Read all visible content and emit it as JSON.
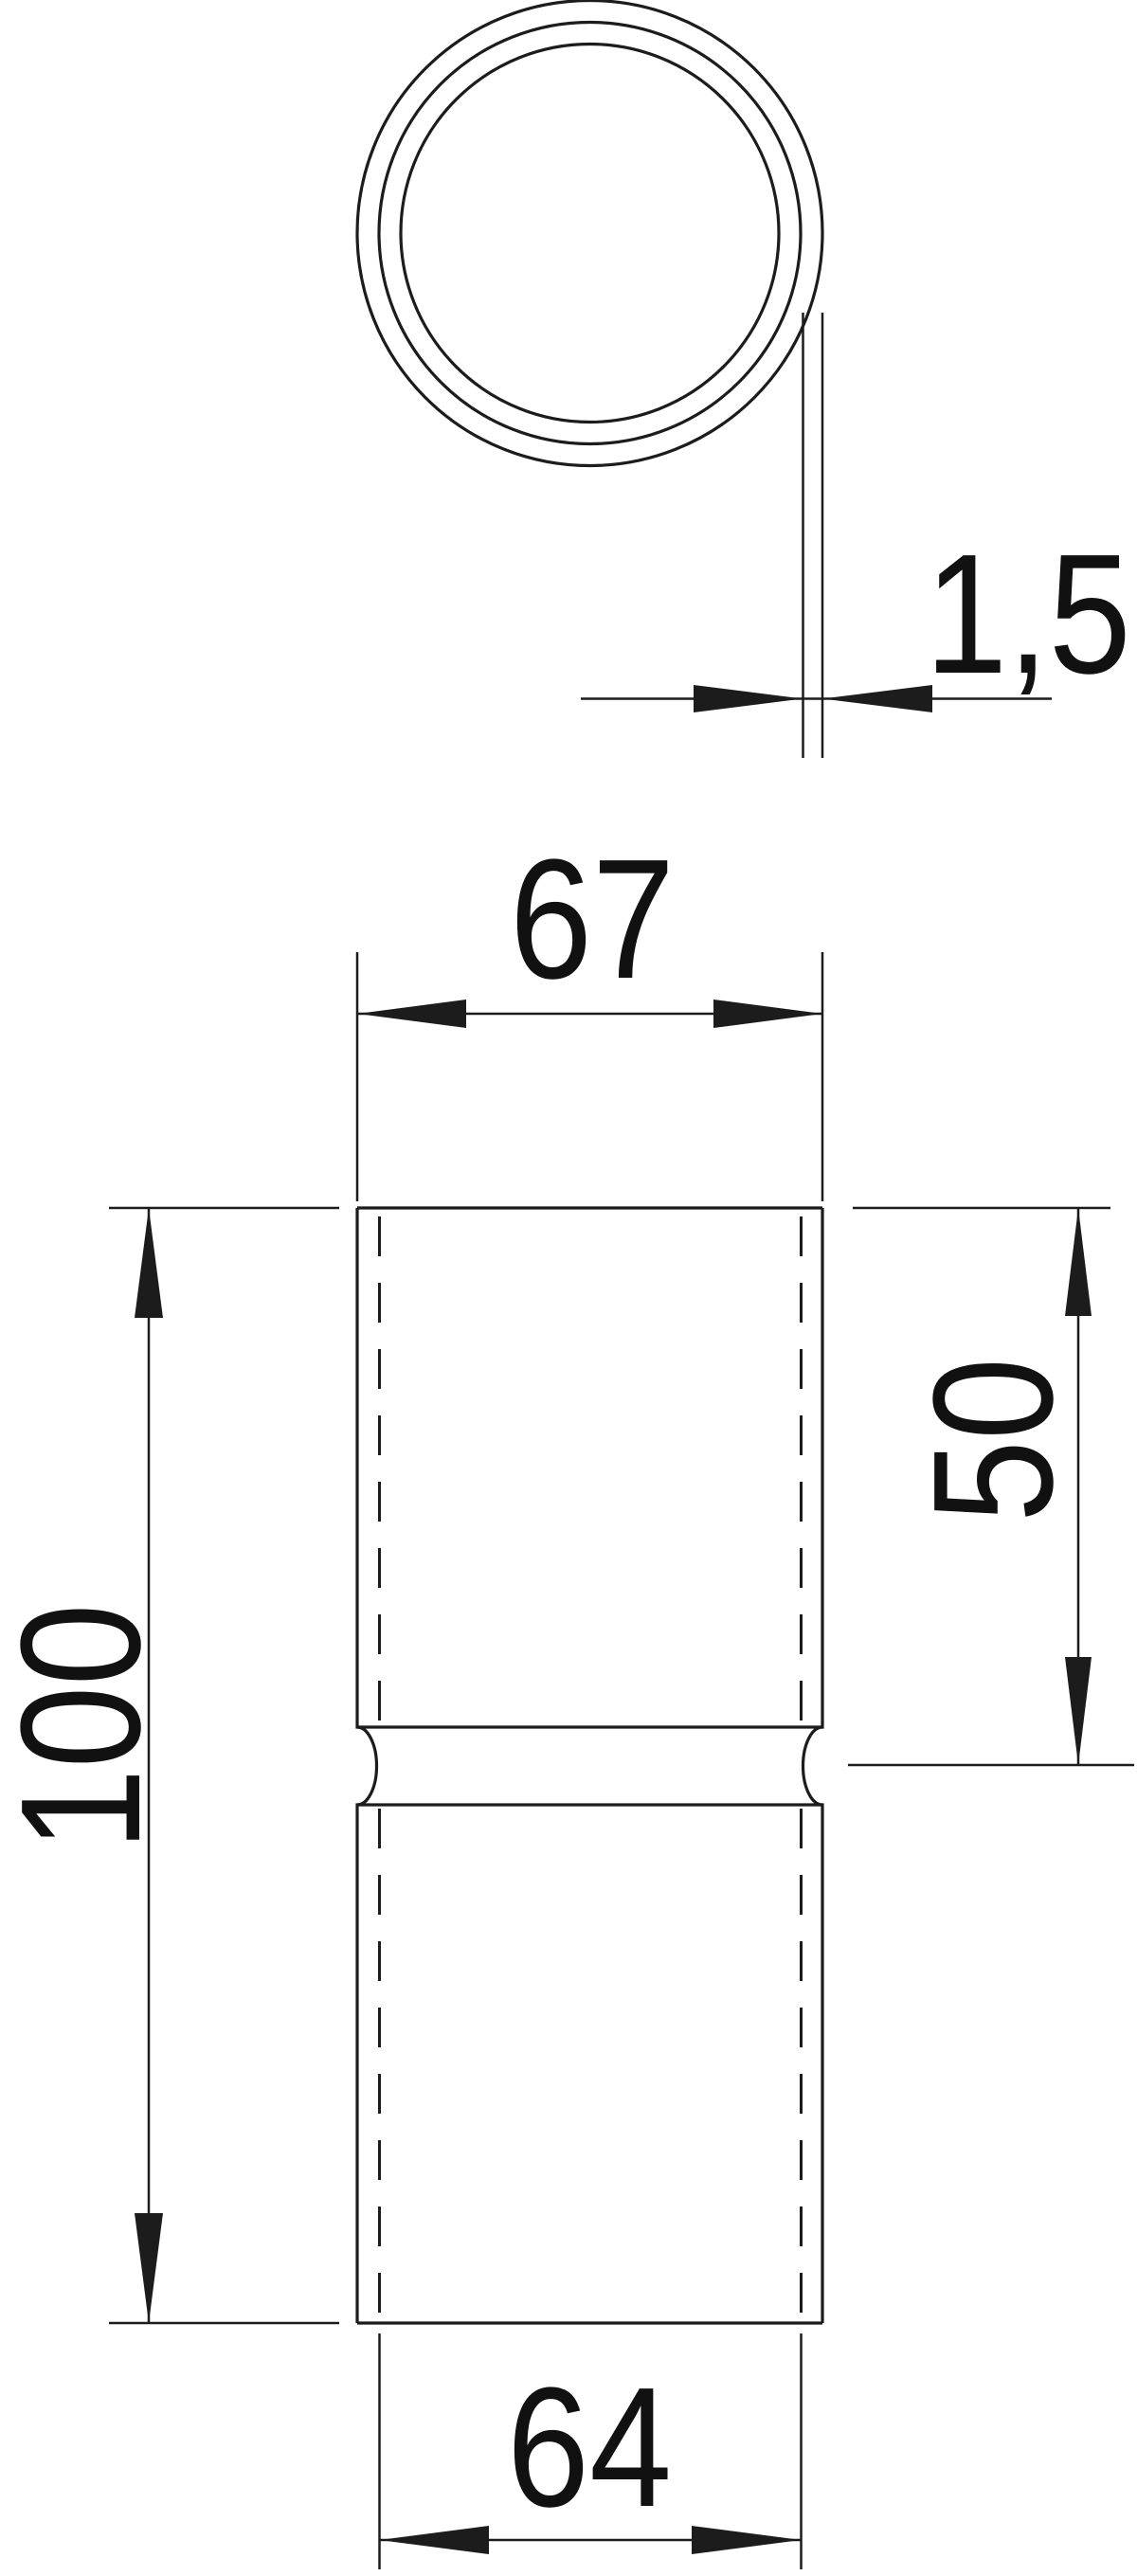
{
  "meta": {
    "drawing_type": "technical dimension drawing",
    "background_color": "#ffffff",
    "line_color": "#1c1c1c",
    "text_color": "#111111"
  },
  "views": {
    "top_view": "tube cross-section (three concentric circles)",
    "front_view": "coupling sleeve with center waist"
  },
  "dimensions": {
    "wall_thickness": {
      "value": "1,5"
    },
    "top_outer_width": {
      "value": "67"
    },
    "overall_length": {
      "value": "100"
    },
    "upper_section_length": {
      "value": "50"
    },
    "bottom_inner_width": {
      "value": "64"
    }
  }
}
